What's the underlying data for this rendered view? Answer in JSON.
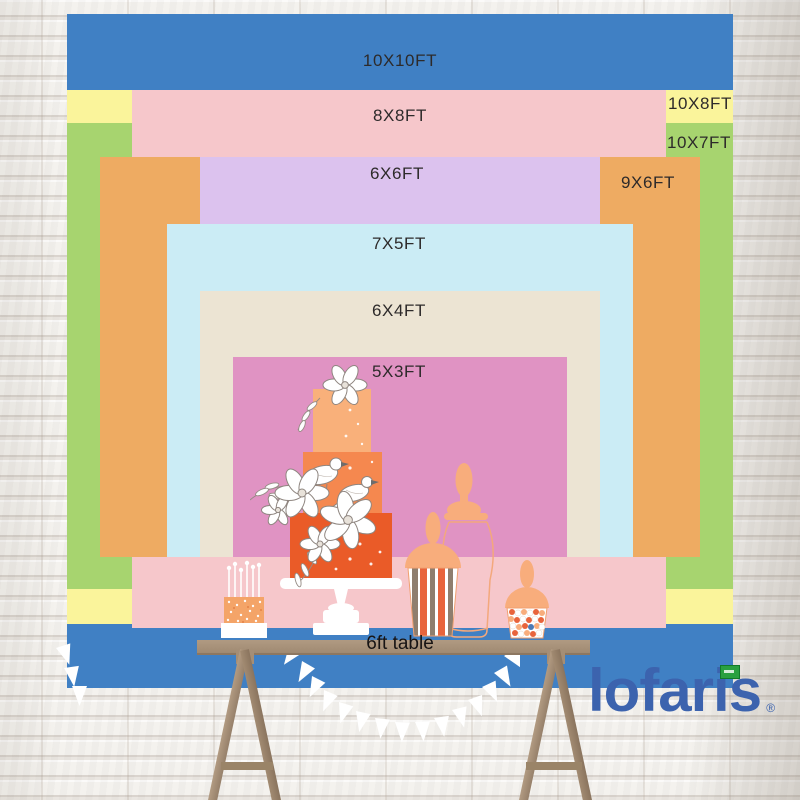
{
  "brand": {
    "name": "lofaris",
    "registered": "®",
    "logo_color": "#3c63ae",
    "flag_color": "#29a03f"
  },
  "backdrop_sizes": [
    {
      "label": "10X10FT",
      "width_ft": 10,
      "height_ft": 10,
      "color": "#4080c4"
    },
    {
      "label": "10X8FT",
      "width_ft": 10,
      "height_ft": 8,
      "color": "#faf49b"
    },
    {
      "label": "10X7FT",
      "width_ft": 10,
      "height_ft": 7,
      "color": "#a7d46f"
    },
    {
      "label": "8X8FT",
      "width_ft": 8,
      "height_ft": 8,
      "color": "#f6c7cb"
    },
    {
      "label": "9X6FT",
      "width_ft": 9,
      "height_ft": 6,
      "color": "#eeab62"
    },
    {
      "label": "6X6FT",
      "width_ft": 6,
      "height_ft": 6,
      "color": "#dcc2ee"
    },
    {
      "label": "7X5FT",
      "width_ft": 7,
      "height_ft": 5,
      "color": "#cbecf5"
    },
    {
      "label": "6X4FT",
      "width_ft": 6,
      "height_ft": 4,
      "color": "#ece4d3"
    },
    {
      "label": "5X3FT",
      "width_ft": 5,
      "height_ft": 3,
      "color": "#e093c3"
    }
  ],
  "table": {
    "label": "6ft table",
    "length_ft": 6
  },
  "decorations": [
    "three-tier-orange-cake-icon",
    "white-flowers-icon",
    "sketched-birds-icon",
    "mini-cake-with-candles-icon",
    "glass-apothecary-jar-icon",
    "striped-candy-cup-icon",
    "candy-cup-icon",
    "white-bunting-flags-icon",
    "white-brick-wall",
    "trestle-table"
  ]
}
